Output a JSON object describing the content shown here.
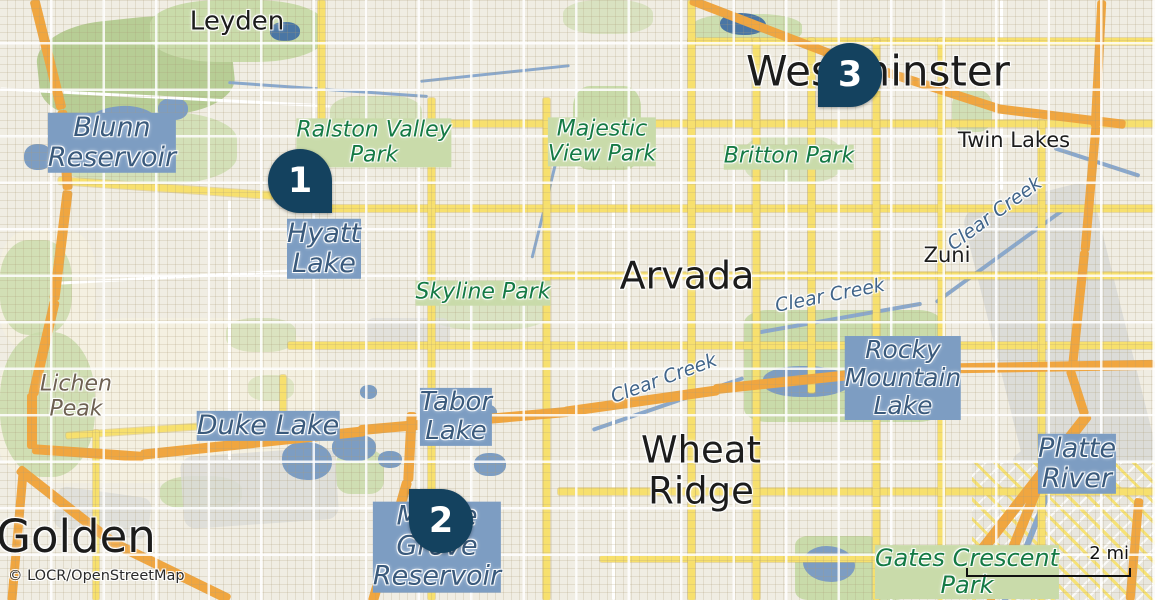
{
  "map": {
    "attribution": "© LOCR/OpenStreetMap",
    "scale_bar": {
      "label": "2 mi"
    },
    "markers": [
      {
        "number": "1",
        "cx": 300,
        "cy": 181,
        "tail": "bottom-right"
      },
      {
        "number": "2",
        "cx": 441,
        "cy": 521,
        "tail": "top-left"
      },
      {
        "number": "3",
        "cx": 850,
        "cy": 75,
        "tail": "bottom-left"
      }
    ],
    "labels": [
      {
        "text": "Leyden",
        "kind": "city",
        "x": 237,
        "y": 22,
        "size": 26
      },
      {
        "text": "Westminster",
        "kind": "city-large",
        "x": 878,
        "y": 71,
        "size": 42
      },
      {
        "text": "Arvada",
        "kind": "city-large",
        "x": 687,
        "y": 276,
        "size": 38
      },
      {
        "text": "Wheat\nRidge",
        "kind": "city-large",
        "x": 701,
        "y": 471,
        "size": 37
      },
      {
        "text": "Golden",
        "kind": "city-large",
        "x": 76,
        "y": 537,
        "size": 45
      },
      {
        "text": "Twin Lakes",
        "kind": "city",
        "x": 1014,
        "y": 141,
        "size": 21
      },
      {
        "text": "Zuni",
        "kind": "city",
        "x": 947,
        "y": 256,
        "size": 21
      },
      {
        "text": "Blunn\nReservoir",
        "kind": "water",
        "x": 112,
        "y": 143,
        "size": 27
      },
      {
        "text": "Hyatt\nLake",
        "kind": "water",
        "x": 324,
        "y": 249,
        "size": 27
      },
      {
        "text": "Duke Lake",
        "kind": "water",
        "x": 268,
        "y": 426,
        "size": 27
      },
      {
        "text": "Tabor\nLake",
        "kind": "water",
        "x": 456,
        "y": 417,
        "size": 26
      },
      {
        "text": "Maple\nGrove\nReservoir",
        "kind": "water",
        "x": 437,
        "y": 547,
        "size": 27
      },
      {
        "text": "Rocky\nMountain\nLake",
        "kind": "water",
        "x": 903,
        "y": 378,
        "size": 25
      },
      {
        "text": "Platte\nRiver",
        "kind": "water",
        "x": 1077,
        "y": 464,
        "size": 27
      },
      {
        "text": "Clear Creek",
        "kind": "water-stream",
        "x": 995,
        "y": 214,
        "size": 19,
        "rotate": -36
      },
      {
        "text": "Clear Creek",
        "kind": "water-stream",
        "x": 830,
        "y": 296,
        "size": 19,
        "rotate": -11
      },
      {
        "text": "Clear Creek",
        "kind": "water-stream",
        "x": 664,
        "y": 379,
        "size": 19,
        "rotate": -20
      },
      {
        "text": "Ralston Valley\nPark",
        "kind": "park",
        "x": 374,
        "y": 143,
        "size": 22
      },
      {
        "text": "Majestic\nView Park",
        "kind": "park",
        "x": 602,
        "y": 142,
        "size": 22
      },
      {
        "text": "Britton Park",
        "kind": "park",
        "x": 789,
        "y": 157,
        "size": 22
      },
      {
        "text": "Skyline Park",
        "kind": "park",
        "x": 483,
        "y": 293,
        "size": 22
      },
      {
        "text": "Gates Crescent\nPark",
        "kind": "park",
        "x": 967,
        "y": 572,
        "size": 24
      },
      {
        "text": "Lichen\nPeak",
        "kind": "peak",
        "x": 76,
        "y": 397,
        "size": 22
      }
    ],
    "colors": {
      "marker_fill": "#14425f",
      "marker_text": "#ffffff",
      "background": "#f0ede3",
      "road_yellow": "#f7e06e",
      "road_orange": "#f0a640",
      "water_fill": "#7d9dc2",
      "park_fill": "#c9dbaa",
      "label_city": "#1c1c1c",
      "label_water": "#3a5a7c",
      "label_park": "#157a45",
      "label_peak": "#6e6152"
    }
  }
}
